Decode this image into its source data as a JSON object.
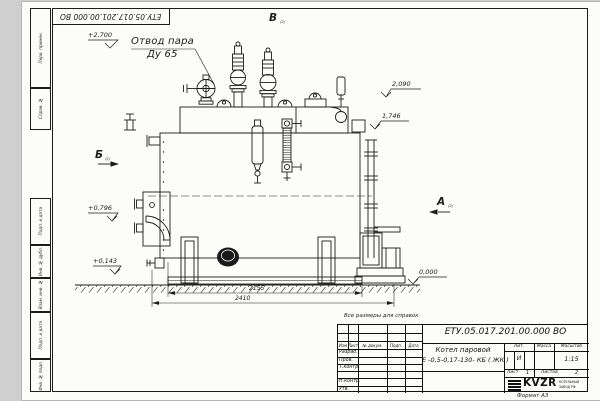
{
  "sheet": {
    "corner_stamp": "ЕТУ.05.017.201.00.000  ВО",
    "reference_note": "Все размеры для справок",
    "format_label": "Формат А3"
  },
  "left_margin": {
    "boxes": [
      {
        "label": "Перв. примен."
      },
      {
        "label": "Справ. №"
      },
      {
        "label": "Подп. и дата"
      },
      {
        "label": "Инв. № дубл."
      },
      {
        "label": "Взам. инв. №"
      },
      {
        "label": "Подп. и дата"
      },
      {
        "label": "Инв. № подл."
      }
    ]
  },
  "callouts": {
    "steam_outlet_line1": "Отвод пара",
    "steam_outlet_line2": "Ду 65"
  },
  "views": {
    "top": {
      "label": "В",
      "ref": "(2)"
    },
    "left": {
      "label": "Б",
      "ref": "(2)"
    },
    "right": {
      "label": "А",
      "ref": "(2)"
    }
  },
  "elevations": [
    {
      "text": "+2,700"
    },
    {
      "text": "2,090"
    },
    {
      "text": "1,746"
    },
    {
      "text": "+0,796"
    },
    {
      "text": "+0,143"
    },
    {
      "text": "0,000"
    }
  ],
  "dimensions": [
    {
      "text": "2155"
    },
    {
      "text": "2410"
    }
  ],
  "title_block": {
    "doc_number": "ЕТУ.05.017.201.00.000  ВО",
    "product_line1": "Котел паровой",
    "product_line2": "Е -0,5-0,17-130- КБ ( ЖК )",
    "rev_headers": {
      "izm": "Изм",
      "list": "Лист",
      "doc": "№ докум.",
      "podp": "Подп.",
      "data": "Дата"
    },
    "roles": {
      "r0": "Разраб.",
      "r1": "Пров.",
      "r2": "Т.контр.",
      "r3": "Н.контр.",
      "r4": "Утв."
    },
    "lit_header": "Лит.",
    "mass_header": "Масса",
    "scale_header": "Масштаб",
    "lit_value": "И",
    "scale_value": "1:15",
    "sheet_label": "Лист",
    "sheet_value": "1",
    "sheets_label": "Листов",
    "sheets_value": "2",
    "logo": {
      "text": "KVZR",
      "sub1": "КОТЕЛЬНЫЙ",
      "sub2": "ЗАВОД РФ"
    }
  }
}
